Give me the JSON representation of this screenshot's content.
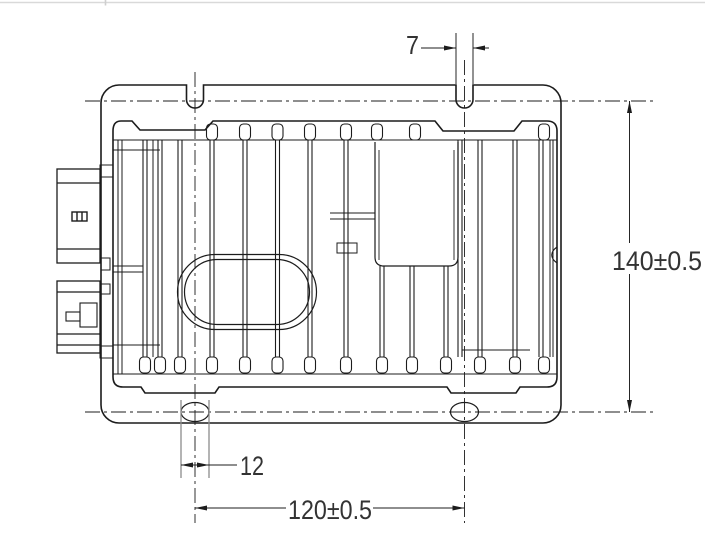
{
  "page": {
    "background": "#ffffff",
    "top_border_color": "#d9d9d9"
  },
  "drawing": {
    "type": "technical-engineering-drawing",
    "dimensions": {
      "notch_width": "7",
      "overall_height": "140±0.5",
      "slot_width": "12",
      "hole_spacing": "120±0.5"
    },
    "colors": {
      "line": "#1c1c1c",
      "extension_line": "#8c8c8c",
      "dimension_text": "#333333"
    }
  }
}
